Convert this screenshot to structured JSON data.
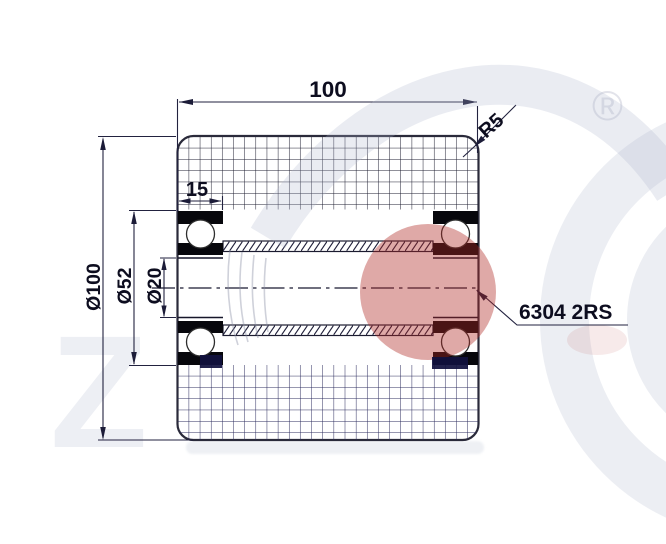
{
  "title": "Polyurethane roller wheel 100x100 cross-section technical drawing",
  "labels": {
    "width": "100",
    "bearing_width": "15",
    "corner_radius": "R5",
    "outer_diameter": "Ø100",
    "bearing_outer_diameter": "Ø52",
    "bore_diameter": "Ø20",
    "bearing_designation": "6304 2RS"
  },
  "watermark": {
    "registered_symbol": "®",
    "letter": "Z"
  },
  "colors": {
    "line_work": "#22223f",
    "dimension_text": "#0d0d1f",
    "bearing_fill": "#07070c",
    "grid_top": "#1d1d30",
    "grid_bottom": "#2c2c5e",
    "watermark_gray": "#edeff4",
    "watermark_red": "rgba(174,40,34,0.40)",
    "watermark_navy": "rgba(17,17,62,0.93)"
  }
}
